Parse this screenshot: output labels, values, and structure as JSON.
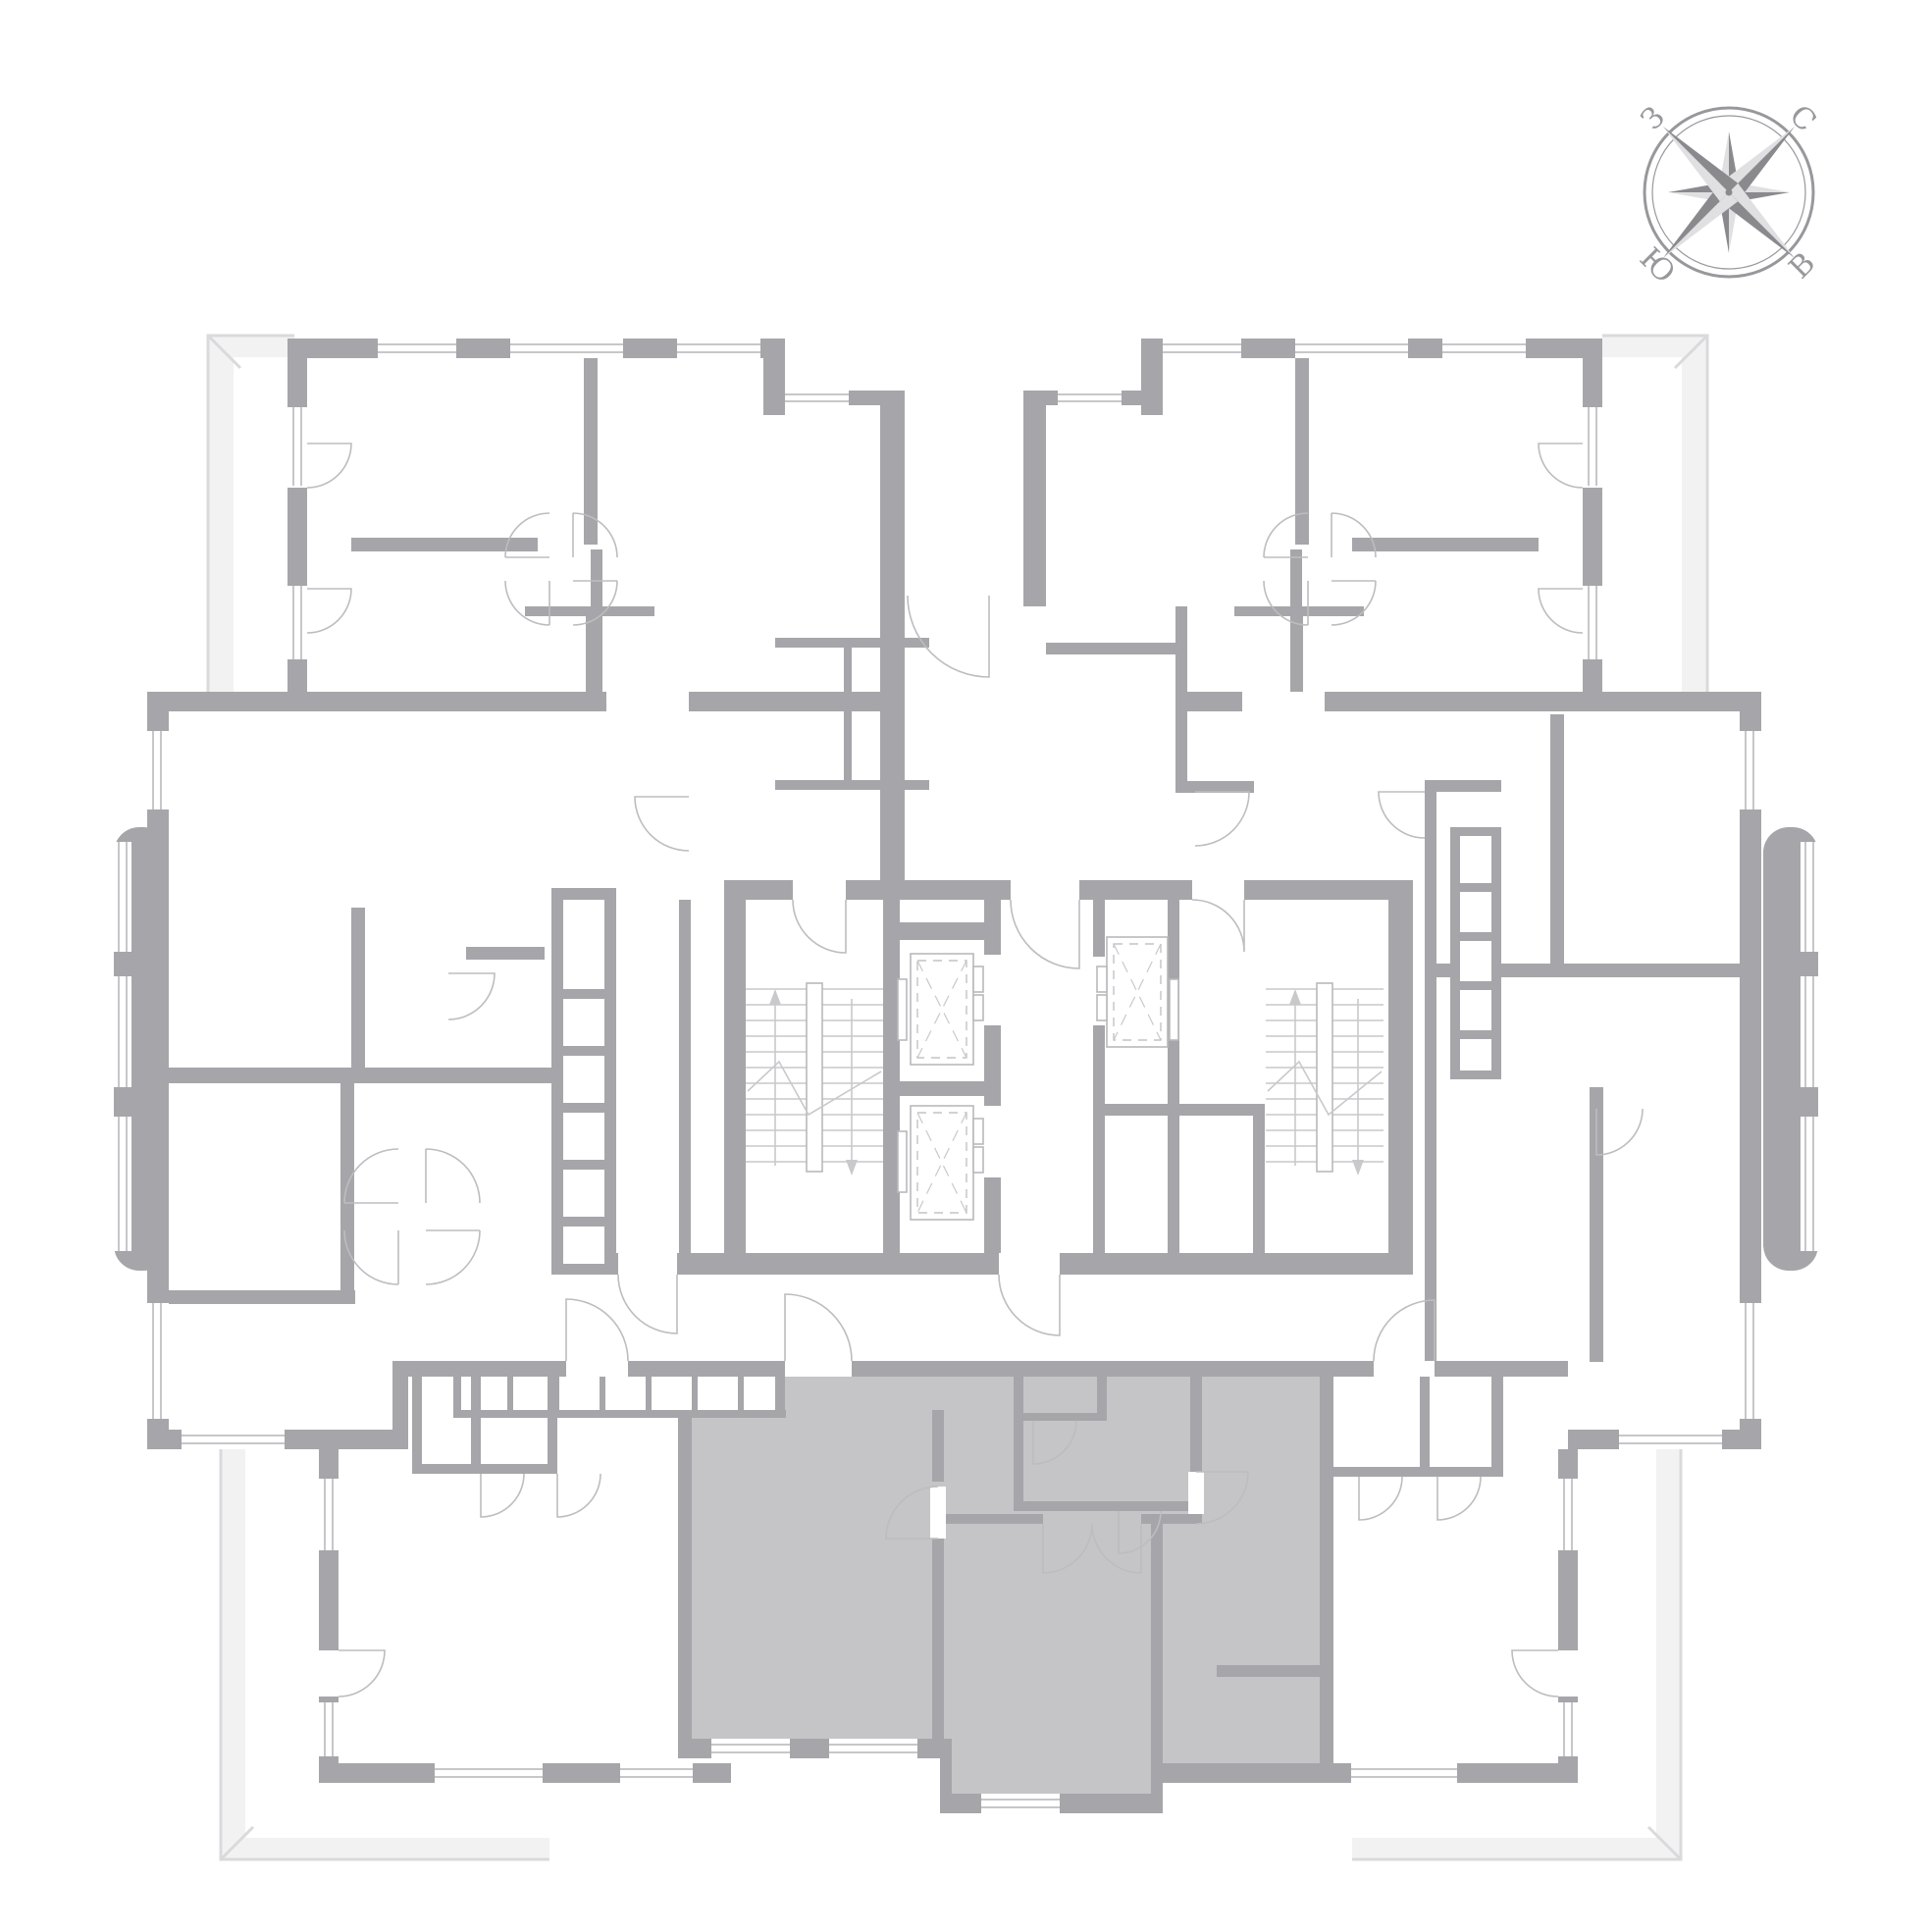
{
  "document": {
    "kind": "residential-floor-plan",
    "background": "#ffffff",
    "highlighted_unit": "bottom-center apartment (selected, gray fill)"
  },
  "compass": {
    "north_label": "С",
    "east_label": "В",
    "south_label": "Ю",
    "west_label": "З"
  },
  "colors": {
    "wall": "#a6a6aa",
    "wall_light": "#c7c7ca",
    "door_arc": "#bdbdc0",
    "stair_detail": "#c9c9cc",
    "balcony_fill": "#f2f2f3",
    "balcony_line": "#dadadc",
    "highlight_fill": "#c5c5c8",
    "background": "#ffffff",
    "compass_gray": "#98989c",
    "compass_dark": "#8a8a8e",
    "compass_light": "#e0e0e2"
  }
}
